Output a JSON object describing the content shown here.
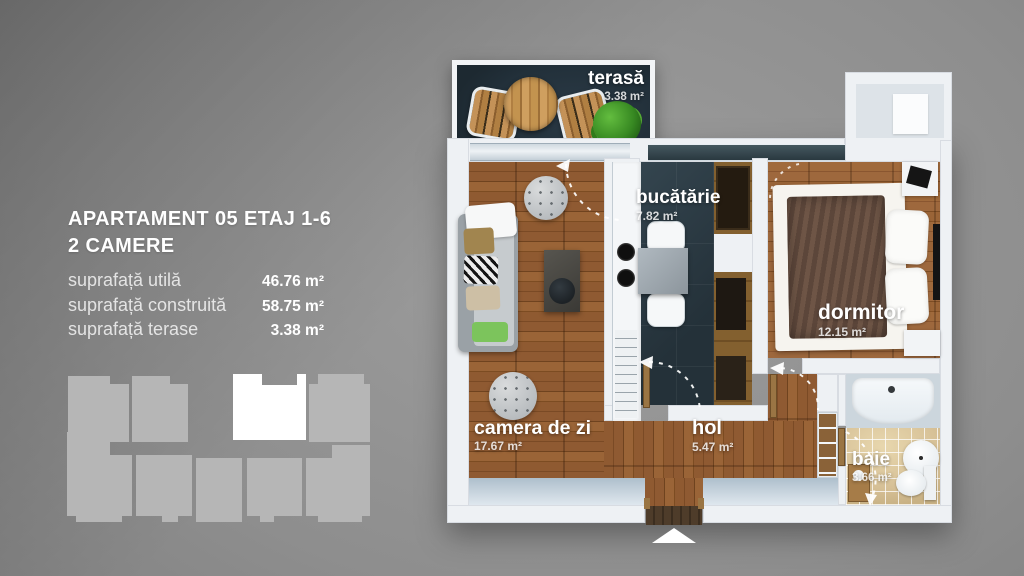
{
  "panel": {
    "title_line1": "APARTAMENT 05 ETAJ 1-6",
    "title_line2": "2 CAMERE",
    "rows": [
      {
        "label": "suprafață utilă",
        "value": "46.76 m²"
      },
      {
        "label": "suprafață construită",
        "value": "58.75 m²"
      },
      {
        "label": "suprafață terase",
        "value": "3.38 m²"
      }
    ]
  },
  "rooms": {
    "terasa": {
      "name": "terasă",
      "area": "3.38 m²"
    },
    "bucatarie": {
      "name": "bucătărie",
      "area": "7.82 m²"
    },
    "dormitor": {
      "name": "dormitor",
      "area": "12.15 m²"
    },
    "camera_de_zi": {
      "name": "camera de zi",
      "area": "17.67 m²"
    },
    "hol": {
      "name": "hol",
      "area": "5.47 m²"
    },
    "baie": {
      "name": "baie",
      "area": "3.66 m²"
    }
  },
  "colors": {
    "background_gray": "#8d8d8d",
    "wall_white": "#eef1f4",
    "terrace_floor": "#24303a",
    "kitchen_floor": "#2c3d46",
    "wood_floor": "#8a5631",
    "bathroom_tile": "#d9c59e",
    "site_plan_unit": "#b6b6b6",
    "site_plan_highlight": "#ffffff",
    "label_text": "#ffffff"
  }
}
